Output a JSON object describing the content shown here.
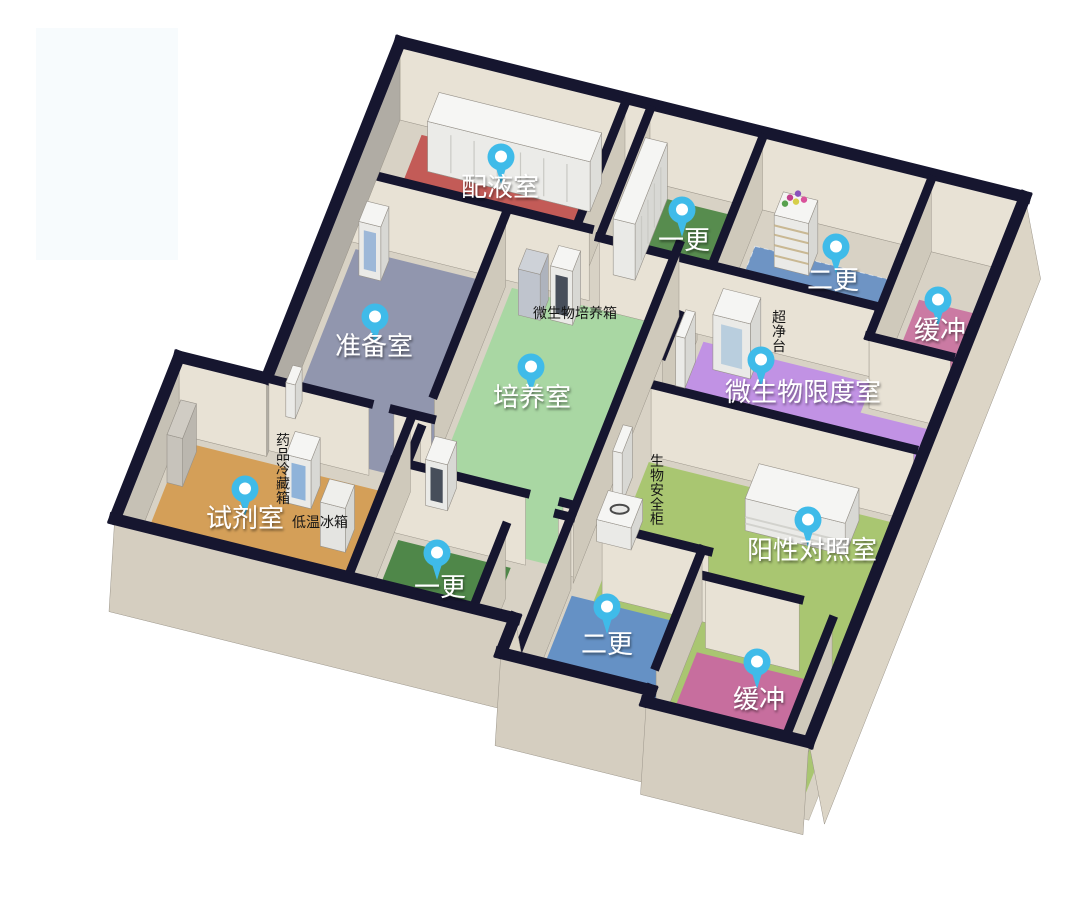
{
  "palette": {
    "background": "#ffffff",
    "watermark": "#f7fbfd",
    "slab": "#d8d2c5",
    "wall_top": "#16162f",
    "wall_face": "#e8e2d5",
    "wall_face_side": "#cfc9bb",
    "wall_face_outer": "#dcd5c6",
    "pin": "#3fbbe9",
    "pin_hole": "#ffffff",
    "room_label_color": "#ffffff",
    "equipment_label_color": "#161616"
  },
  "rooms": [
    {
      "id": "peiyeshi",
      "label": "配液室",
      "floor_color": "#c35b57"
    },
    {
      "id": "yigeng_top",
      "label": "一更",
      "floor_color": "#578c4e"
    },
    {
      "id": "ergeng_top",
      "label": "二更",
      "floor_color": "#6e94c4"
    },
    {
      "id": "huanchong_top",
      "label": "缓冲",
      "floor_color": "#cb7aa3"
    },
    {
      "id": "zhunbeishi",
      "label": "准备室",
      "floor_color": "#9196ae"
    },
    {
      "id": "peiyangshi",
      "label": "培养室",
      "floor_color": "#a9d7a3"
    },
    {
      "id": "weishengwu_xiandushi",
      "label": "微生物限度室",
      "floor_color": "#c192e4"
    },
    {
      "id": "yangxing_duizhaoshi",
      "label": "阳性对照室",
      "floor_color": "#a9c671"
    },
    {
      "id": "shijishi",
      "label": "试剂室",
      "floor_color": "#d49f58"
    },
    {
      "id": "yigeng_bottom",
      "label": "一更",
      "floor_color": "#4f8749"
    },
    {
      "id": "ergeng_bottom",
      "label": "二更",
      "floor_color": "#6591c5"
    },
    {
      "id": "huanchong_bottom",
      "label": "缓冲",
      "floor_color": "#c76e9e"
    }
  ],
  "equipment_labels": [
    {
      "id": "microbial-incubator",
      "label": "微生物培养箱",
      "orientation": "horizontal"
    },
    {
      "id": "clean-bench",
      "label": "超净台",
      "orientation": "vertical"
    },
    {
      "id": "biosafety-cabinet",
      "label": "生物安全柜",
      "orientation": "vertical"
    },
    {
      "id": "medicine-fridge",
      "label": "药品冷藏箱",
      "orientation": "vertical"
    },
    {
      "id": "low-temp-freezer",
      "label": "低温冰箱",
      "orientation": "horizontal"
    }
  ]
}
